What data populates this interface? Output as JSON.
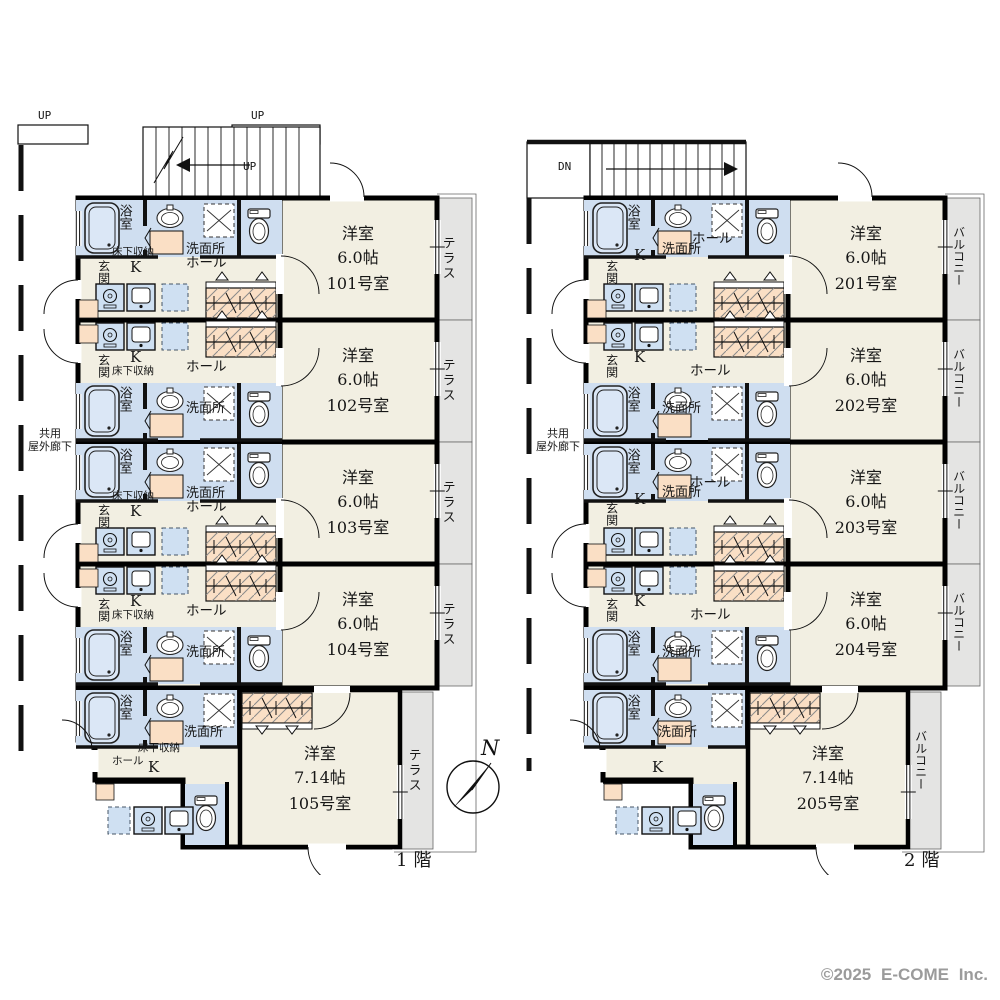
{
  "page": {
    "compass": "N",
    "copyright": "©2025 E-COME Inc."
  },
  "palette": {
    "wall": "#000000",
    "room_floor": "#F2EFE2",
    "wet_area": "#CFDEF0",
    "accent_mat": "#FADFC5",
    "outdoor": "#E4E4E3"
  },
  "labels": {
    "bath": "浴室",
    "washroom": "洗面所",
    "entrance": "玄関",
    "hall": "ホール",
    "kitchen": "K",
    "underfloor_storage": "床下収納",
    "corridor_line1": "共用",
    "corridor_line2": "屋外廊下"
  },
  "floor1": {
    "label": "1階",
    "outdoor": "テラス",
    "stairs": {
      "left": "UP",
      "right": "UP",
      "arrow": "UP"
    },
    "rooms": [
      {
        "type": "洋室",
        "size": "6.0帖",
        "number": "101号室"
      },
      {
        "type": "洋室",
        "size": "6.0帖",
        "number": "102号室"
      },
      {
        "type": "洋室",
        "size": "6.0帖",
        "number": "103号室"
      },
      {
        "type": "洋室",
        "size": "6.0帖",
        "number": "104号室"
      },
      {
        "type": "洋室",
        "size": "7.14帖",
        "number": "105号室"
      }
    ]
  },
  "floor2": {
    "label": "2階",
    "outdoor": "バルコニー",
    "stairs": {
      "arrow": "DN"
    },
    "rooms": [
      {
        "type": "洋室",
        "size": "6.0帖",
        "number": "201号室"
      },
      {
        "type": "洋室",
        "size": "6.0帖",
        "number": "202号室"
      },
      {
        "type": "洋室",
        "size": "6.0帖",
        "number": "203号室"
      },
      {
        "type": "洋室",
        "size": "6.0帖",
        "number": "204号室"
      },
      {
        "type": "洋室",
        "size": "7.14帖",
        "number": "205号室"
      }
    ]
  }
}
